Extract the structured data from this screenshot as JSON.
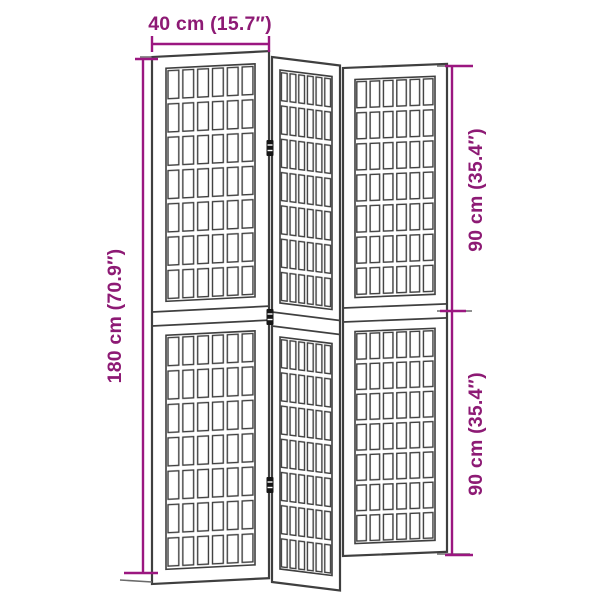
{
  "scene": {
    "background": "#ffffff",
    "colors": {
      "dimension_line": "#9B1780",
      "dimension_text": "#8D1A74",
      "panel_outline": "#3f3f3f",
      "panel_fill": "#ffffff",
      "extension_line": "#6b6b6b",
      "hinge": "#161616"
    },
    "dimensions": {
      "width": {
        "label": "40 cm (15.7″)"
      },
      "height_total": {
        "label": "180 cm (70.9″)"
      },
      "height_upper": {
        "label": "90 cm (35.4″)"
      },
      "height_lower": {
        "label": "90 cm (35.4″)"
      }
    },
    "illustration": {
      "subject": "folding room divider",
      "panel_count": 3,
      "sections_per_panel": 2,
      "grid_columns_per_panel": 6,
      "grid_rows_per_section": 7
    }
  }
}
